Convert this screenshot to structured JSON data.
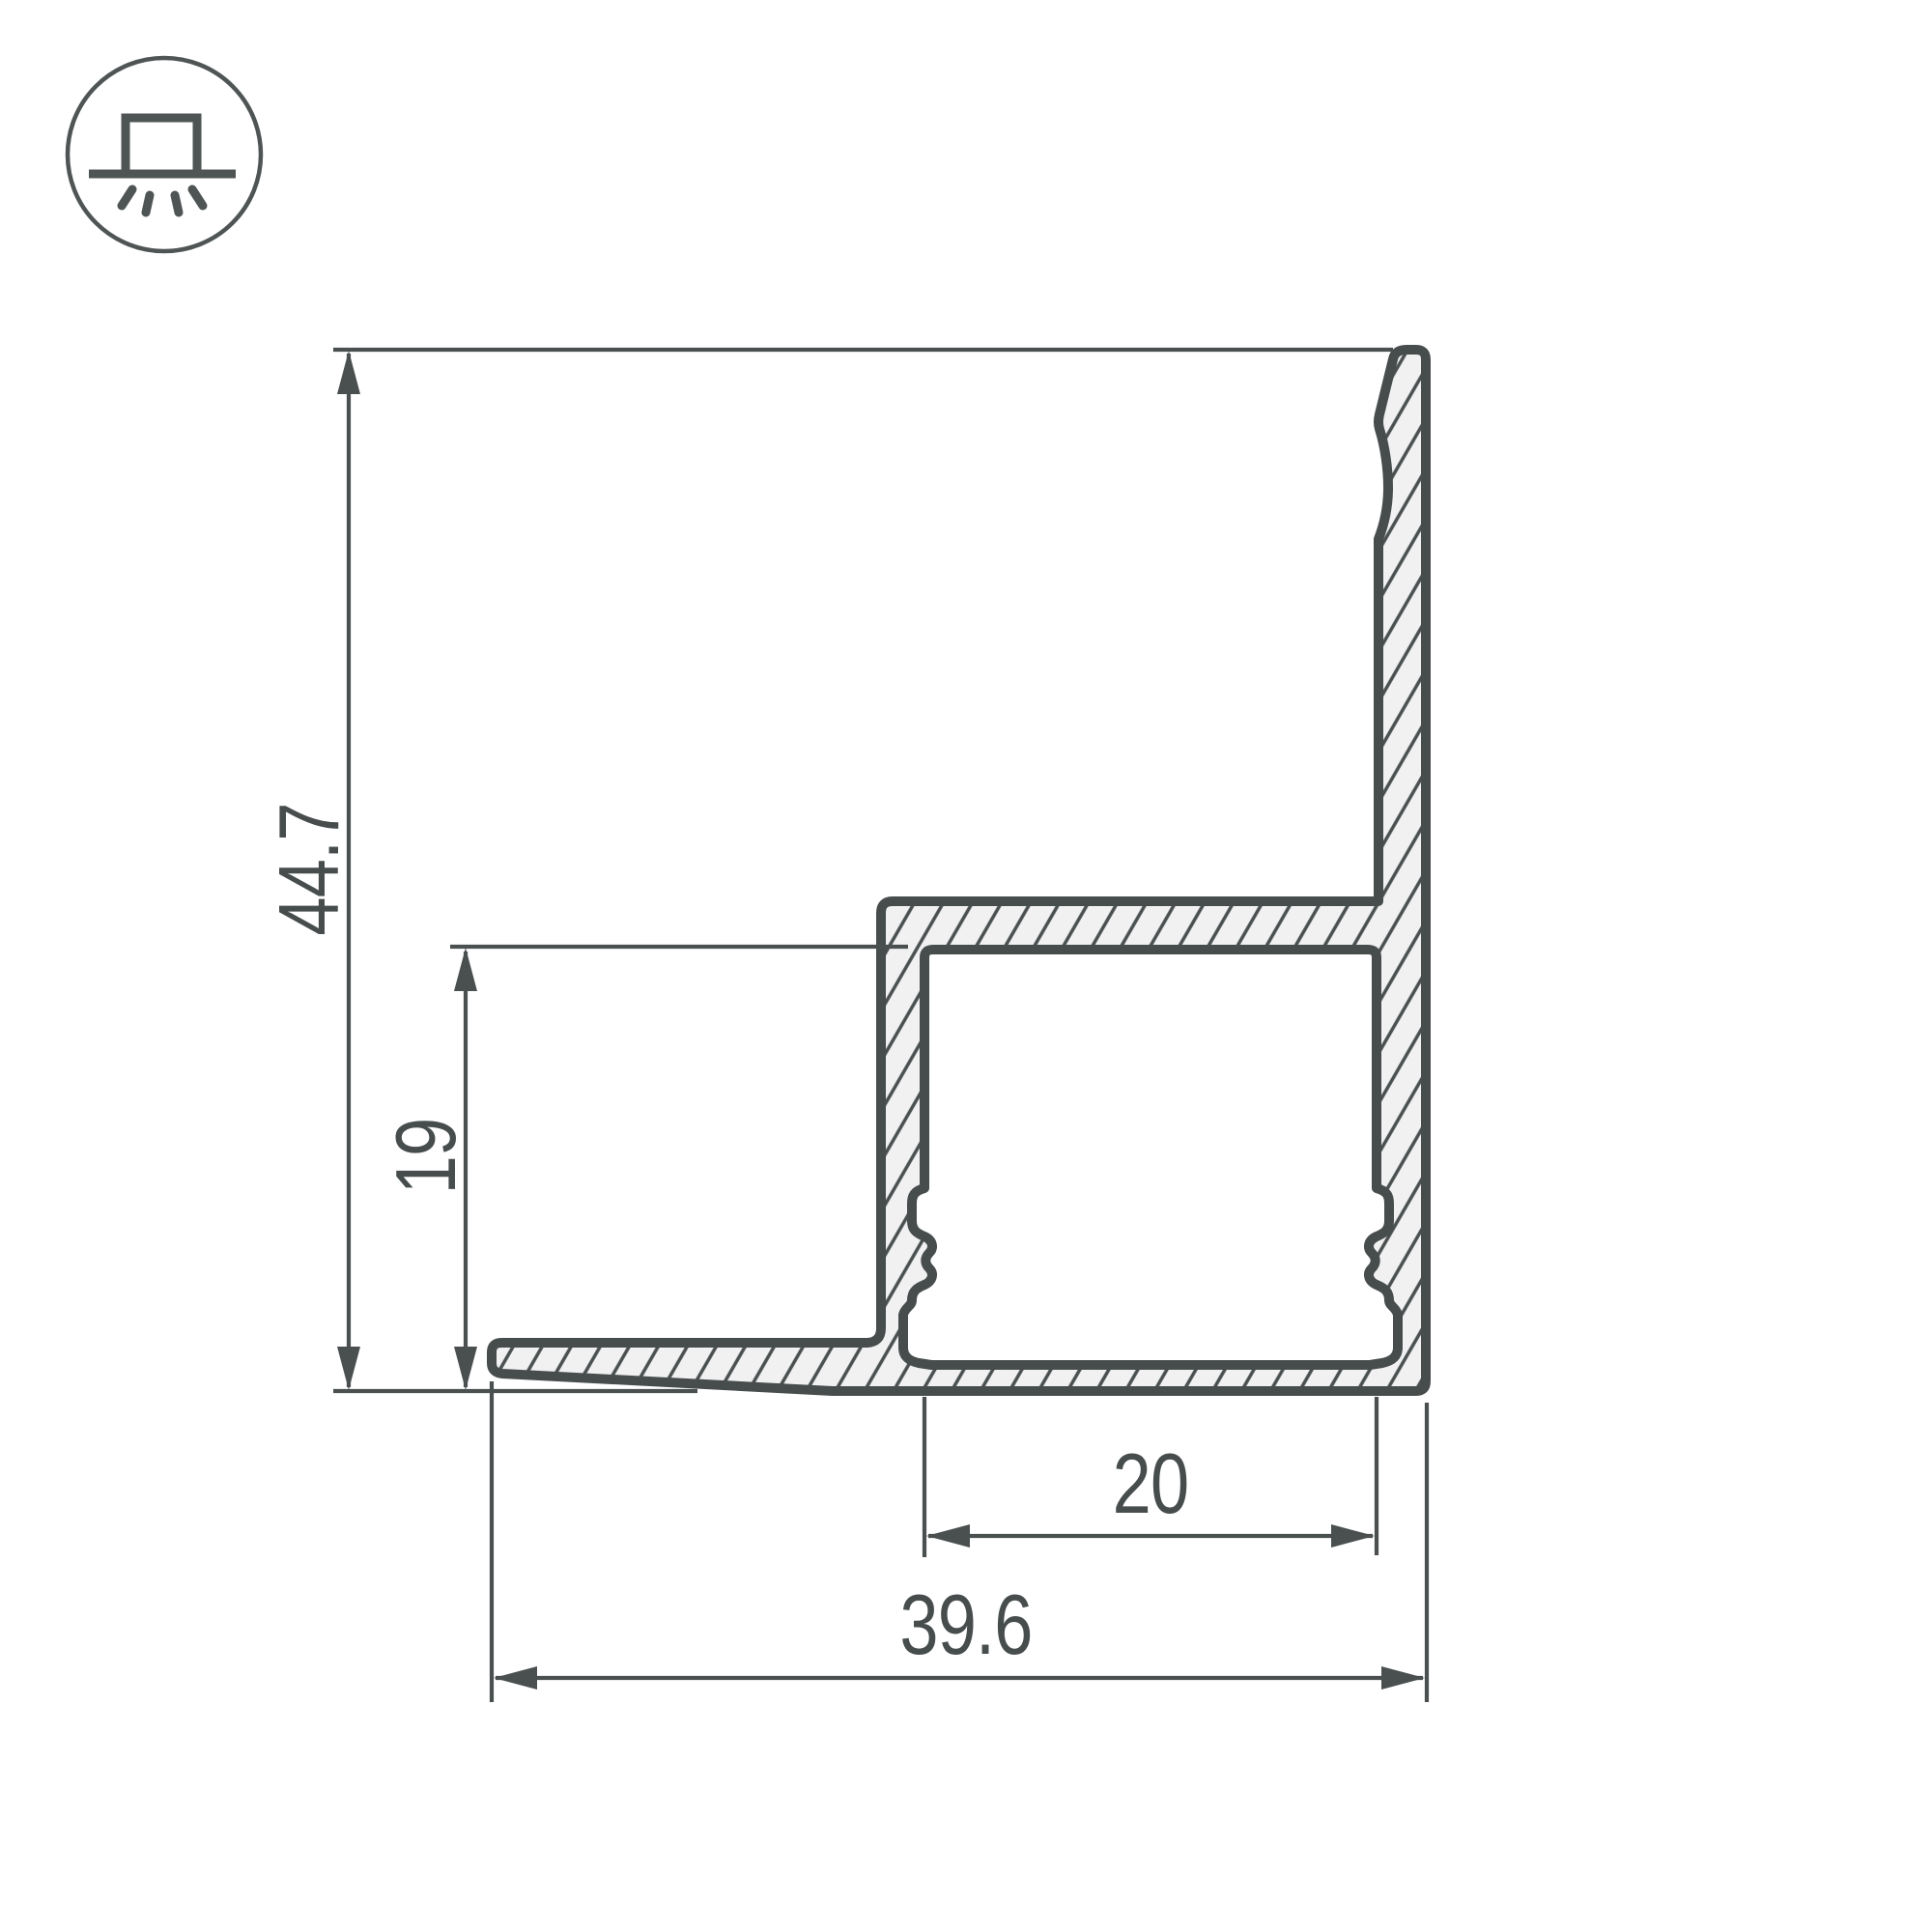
{
  "drawing": {
    "title": "LED profile cross-section technical drawing",
    "icon": "surface-mounted-luminaire-icon",
    "dimensions": {
      "overall_height": "44.7",
      "base_height": "19",
      "channel_width": "20",
      "overall_width": "39.6"
    },
    "colors": {
      "line": "#474d4d",
      "thin": "#4a5050",
      "material_fill": "#f1f1f2",
      "hatch": "#4a5050",
      "background": "#ffffff"
    }
  }
}
